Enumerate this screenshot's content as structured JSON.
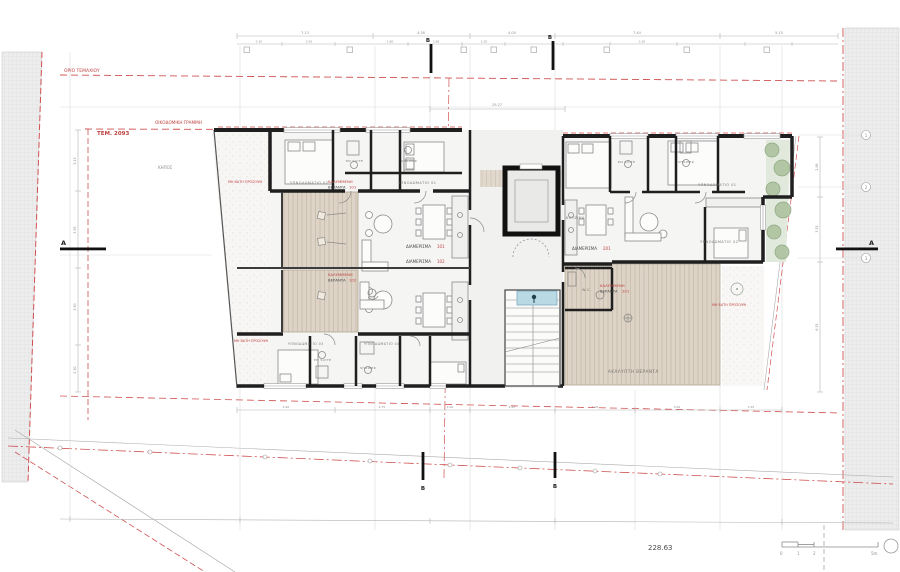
{
  "drawing": {
    "type": "architectural-floor-plan",
    "level_value": "228.63"
  },
  "labels": {
    "plot_boundary": "ΟΡΙΟ ΤΕΜΑΧΙΟΥ",
    "building_line": "ΟΙΚΟΔΟΜΙΚΗ ΓΡΑΜΜΗ",
    "parcel": "ΤΕΜ. 2093",
    "garden": "ΚΗΠΟΣ",
    "non_walkable": "ΜΗ ΒΑΤΗ ΠΡΟΣΟΨΗ",
    "covered": "ΚΑΛΥΜΜΕΝΗ",
    "veranda": "ΒΕΡΑΝΤΑ",
    "open_veranda": "ΑΚΑΛΥΠΤΗ ΒΕΡΑΝΤΑ",
    "apt": "ΔΙΑΜΕΡΙΣΜΑ",
    "num101": "101",
    "num102": "102",
    "num201": "201",
    "bedroom01": "ΥΠΝΟΔΩΜΑΤΙΟ 01",
    "bedroom02": "ΥΠΝΟΔΩΜΑΤΙΟ 02",
    "bedroom03": "ΥΠΝΟΔΩΜΑΤΙΟ 03",
    "bedroom04": "ΥΠΝΟΔΩΜΑΤΙΟ 04",
    "ensuite": "EN SUITE",
    "shower": "SHOWER",
    "wc": "W.C.",
    "kitchen": "ΚΟΥΖΙΝΑ",
    "level": "228.63",
    "section_a": "A",
    "section_b": "B",
    "scale0": "0",
    "scale1": "1",
    "scale2": "2",
    "scale5": "5m"
  },
  "grid": [
    "1",
    "2",
    "3"
  ],
  "dims": [
    "7.13",
    "4.38",
    "4.00",
    "7.44",
    "5.15",
    "2.10",
    "2.55",
    "1.80",
    "2.88",
    "2.20",
    "3.30",
    "3.13",
    "3.95",
    "3.90",
    "2.30",
    "2.88",
    "3.55",
    "6.55",
    "4.90",
    "4.75",
    "2.00",
    "4.25",
    "4.00",
    "3.00",
    "2.35",
    "29.27"
  ],
  "colors": {
    "boundary_red": "#bf4040",
    "wall": "#1f1f1f",
    "veranda_fill": "#ddd3c6",
    "veranda_stripe": "#cbbfad",
    "vegetation": "#aec3a0",
    "stair_blue": "#b9d9e4",
    "dimension_gray": "#9a9a9a"
  }
}
